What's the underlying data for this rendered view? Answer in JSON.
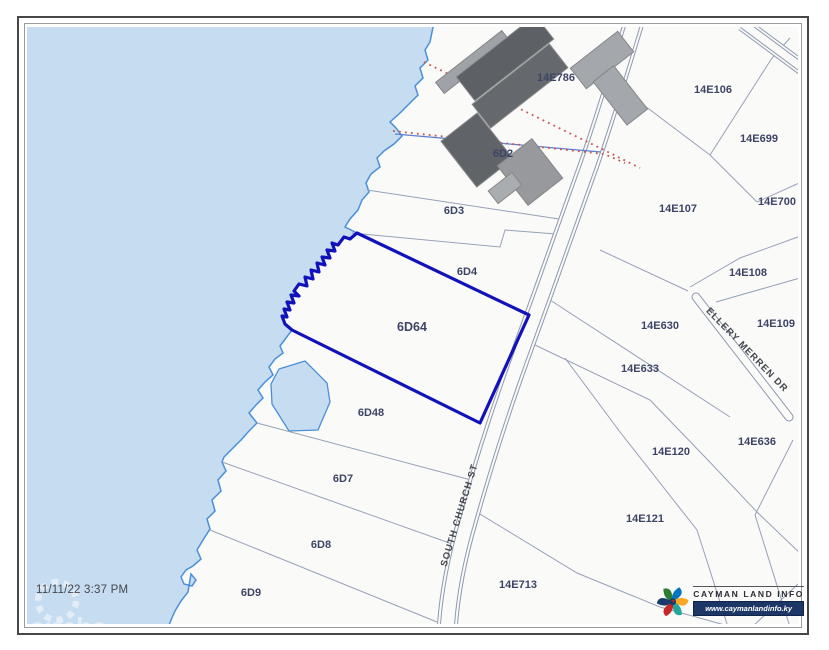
{
  "map": {
    "timestamp": "11/11/22 3:37 PM",
    "selected_parcel": "6D64",
    "watermark": "cireba",
    "parcels": [
      {
        "label": "14E786"
      },
      {
        "label": "6D2"
      },
      {
        "label": "6D3"
      },
      {
        "label": "6D4"
      },
      {
        "label": "6D64",
        "selected": true
      },
      {
        "label": "6D48"
      },
      {
        "label": "6D7"
      },
      {
        "label": "6D8"
      },
      {
        "label": "6D9"
      },
      {
        "label": "14E106"
      },
      {
        "label": "14E699"
      },
      {
        "label": "14E107"
      },
      {
        "label": "14E700"
      },
      {
        "label": "14E108"
      },
      {
        "label": "14E630"
      },
      {
        "label": "14E109"
      },
      {
        "label": "14E633"
      },
      {
        "label": "14E120"
      },
      {
        "label": "14E636"
      },
      {
        "label": "14E121"
      },
      {
        "label": "14E713"
      }
    ],
    "roads": [
      {
        "name": "SOUTH CHURCH ST"
      },
      {
        "name": "ELLERY MERREN DR"
      }
    ],
    "colors": {
      "water": "#c6dcf0",
      "coastline": "#4a90d9",
      "selected_outline": "#1212bb",
      "parcel_line": "#97a1b6",
      "label_text": "#3e4466",
      "survey_dots": "#c4574e"
    }
  },
  "branding": {
    "name": "CAYMAN LAND INFO",
    "website": "www.caymanlandinfo.ky"
  }
}
